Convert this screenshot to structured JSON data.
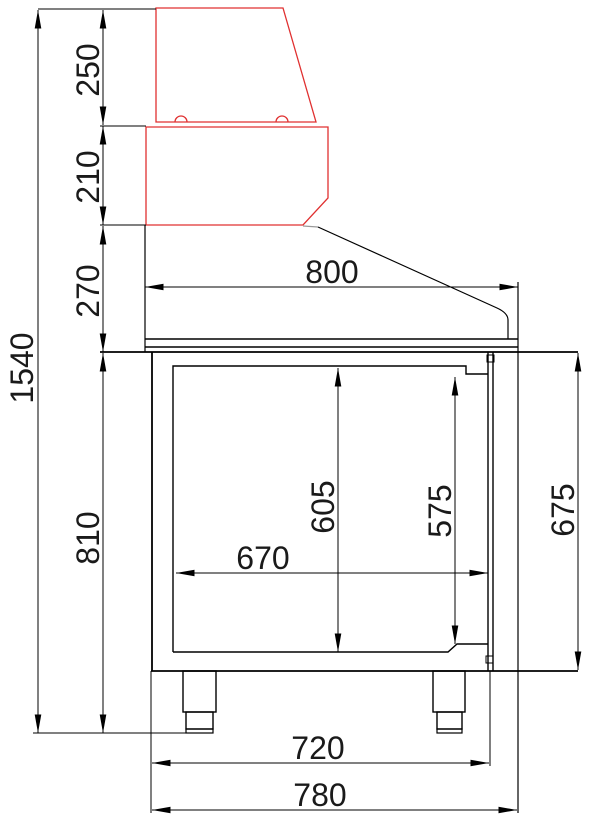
{
  "drawing": {
    "type": "technical-side-view",
    "subject": "refrigerated-saladette-counter-with-glass-display",
    "colors": {
      "background": "#ffffff",
      "outline": "#000000",
      "highlight": "#e03030"
    },
    "dimensions": {
      "glass_top_height": "250",
      "glass_base_height": "210",
      "worktop_section_height": "270",
      "total_height": "1540",
      "body_with_legs_height": "810",
      "worktop_depth": "800",
      "interior_height": "605",
      "door_opening_height": "575",
      "body_side_height": "675",
      "interior_depth": "670",
      "body_depth": "720",
      "total_depth": "780"
    }
  }
}
